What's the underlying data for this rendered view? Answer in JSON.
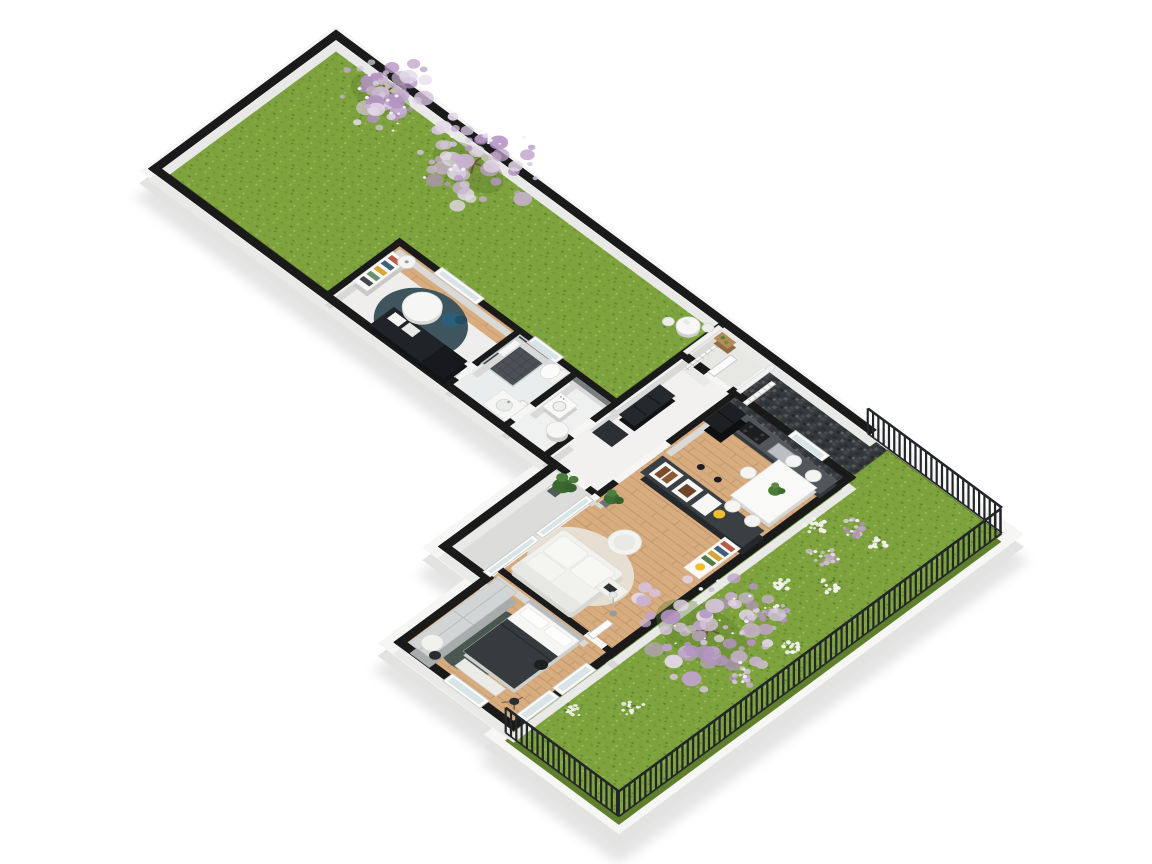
{
  "scene": {
    "canvas": {
      "width": 1152,
      "height": 864,
      "background": "#ffffff"
    },
    "view": {
      "translate": [
        336,
        40
      ],
      "scale_y": 0.74,
      "rotate_deg": 45
    },
    "palette": {
      "grass": "#7da23e",
      "grass_dark": "#5f7f2d",
      "grass_light": "#9dc258",
      "wall_top": "#1a1a1a",
      "wall_side_outer": "#e9e9e8",
      "wall_side_inner": "#d9d9d8",
      "slab": "#f6f6f5",
      "slab_side": "#e3e3e2",
      "shadow": "#000000",
      "floor_white": "#efeeec",
      "wood": "#d7ac7e",
      "wood_line": "#c5966b",
      "dark_tile": "#35393b",
      "counter": "#50565a",
      "island": "#3a3f43",
      "furniture_black": "#202327",
      "rug_office": "#3f555e",
      "chair_blue": "#2c5e79",
      "rug_bedroom": "#4a5751",
      "blanket": "#363b3e",
      "wardrobe": "#d2d5d5",
      "sofa_white": "#f1f1ee",
      "patio": "#dcdcda",
      "glass": "#d9e4e6",
      "blossom": [
        "#c9b2d2",
        "#d6c4de",
        "#bfa3cb",
        "#e4d9ea",
        "#b493c3"
      ],
      "blossom_highlight": "#f3eef6",
      "flower_white": "#f4f4f1",
      "leaf_green": "#5d8034",
      "fence": "#23262a",
      "trunk": "#6d5440",
      "accent_yellow": "#f2bd2c"
    },
    "walls": {
      "height_offset": 11,
      "outer": [
        [
          -10,
          -10,
          765,
          10
        ],
        [
          -10,
          -10,
          10,
          266
        ],
        [
          -10,
          246,
          576,
          10
        ],
        [
          556,
          246,
          10,
          166
        ],
        [
          556,
          402,
          70,
          10
        ],
        [
          616,
          402,
          10,
          133
        ],
        [
          616,
          525,
          166,
          10
        ],
        [
          776,
          50,
          10,
          485
        ],
        [
          541,
          50,
          39,
          10
        ],
        [
          612,
          50,
          88,
          10
        ],
        [
          744,
          50,
          42,
          10
        ]
      ],
      "inner": [
        [
          234,
          144,
          315,
          8
        ],
        [
          234,
          144,
          8,
          106
        ],
        [
          404,
          148,
          8,
          64
        ],
        [
          404,
          238,
          8,
          12
        ],
        [
          484,
          148,
          8,
          62
        ],
        [
          484,
          238,
          8,
          12
        ],
        [
          541,
          -6,
          8,
          188
        ],
        [
          541,
          212,
          8,
          38
        ],
        [
          616,
          50,
          8,
          100
        ],
        [
          616,
          224,
          8,
          26
        ],
        [
          616,
          386,
          128,
          8
        ],
        [
          770,
          386,
          16,
          8
        ],
        [
          566,
          246,
          12,
          8
        ],
        [
          606,
          246,
          10,
          8
        ]
      ]
    },
    "fences": {
      "height": 24,
      "post_step": 7.5,
      "segments": [
        {
          "along": "u",
          "at": 0,
          "from": 752,
          "to": 942
        },
        {
          "along": "v",
          "at": 942,
          "from": 2,
          "to": 542
        },
        {
          "along": "u",
          "at": 542,
          "from": 782,
          "to": 942
        }
      ]
    },
    "trees": [
      {
        "u": 85,
        "v": 14,
        "r": 60
      },
      {
        "u": 215,
        "v": 20,
        "r": 72
      },
      {
        "u": 826,
        "v": 300,
        "r": 94
      }
    ],
    "lilac_shrubs": [
      [
        832,
        100,
        16
      ],
      [
        838,
        148,
        18
      ],
      [
        858,
        240,
        20
      ],
      [
        895,
        322,
        15
      ]
    ],
    "flower_shrubs": [
      [
        806,
        126,
        15
      ],
      [
        864,
        96,
        13
      ],
      [
        872,
        170,
        14
      ],
      [
        836,
        206,
        11
      ],
      [
        902,
        258,
        11
      ],
      [
        848,
        428,
        13
      ],
      [
        806,
        472,
        12
      ]
    ]
  }
}
